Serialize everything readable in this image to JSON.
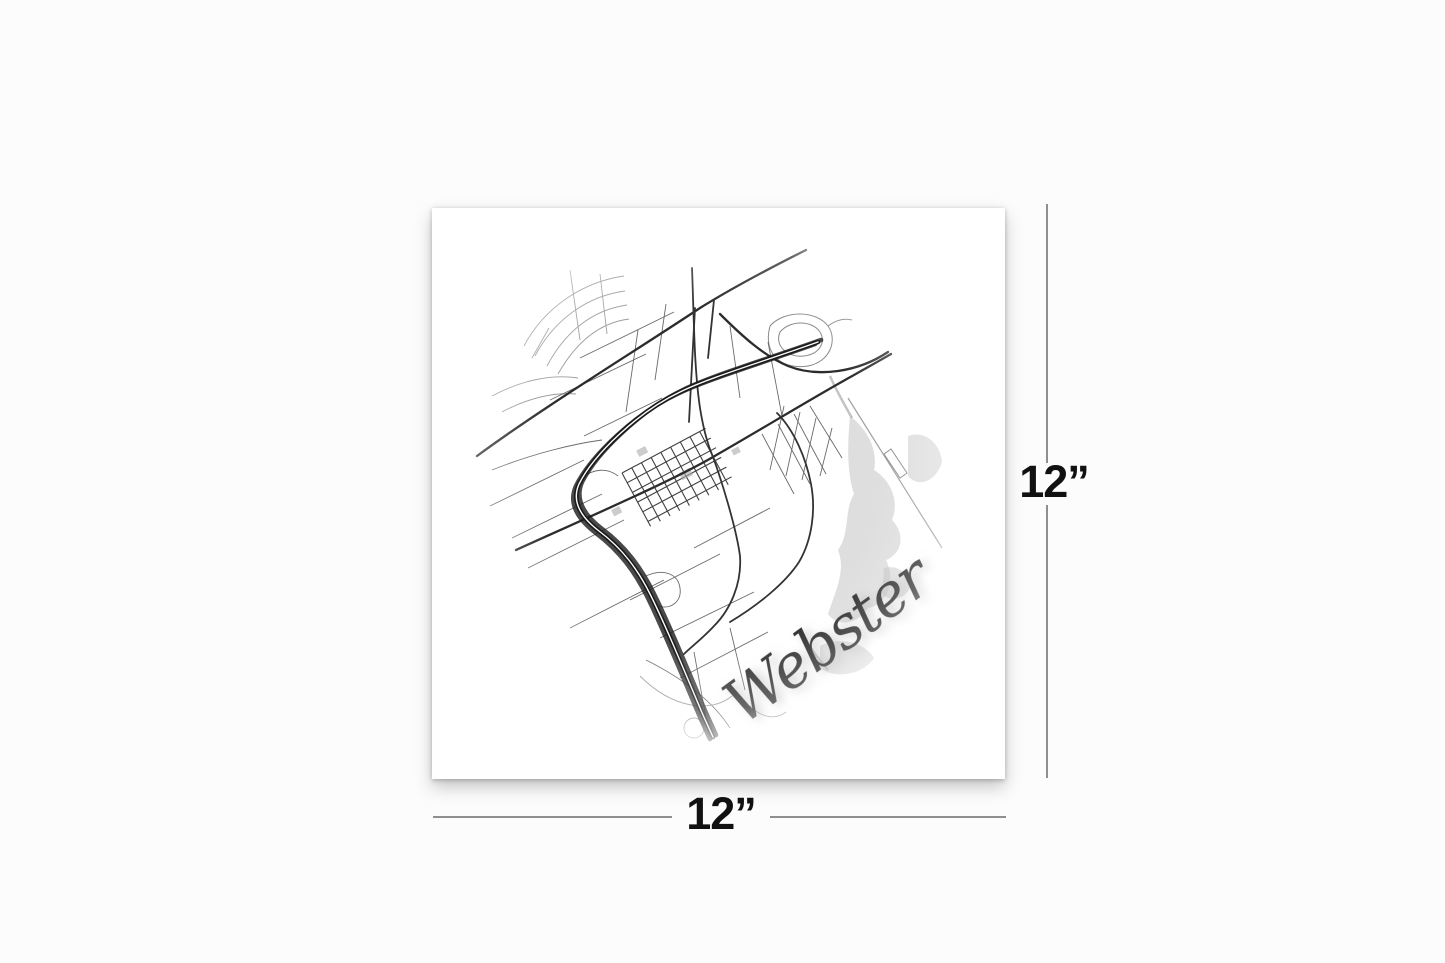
{
  "artwork": {
    "type": "minimalist-circular-city-street-map-print",
    "city_script": "Webster",
    "map_icon": "circular-street-map"
  },
  "dimensions": {
    "width_label": "12”",
    "height_label": "12”"
  },
  "colors": {
    "page_background": "#fcfcfc",
    "print_background": "#ffffff",
    "road_dark": "#1a1a1a",
    "road_medium": "#2c2c2c",
    "road_light": "#6a6a6a",
    "road_faint": "#999999",
    "water_gray": "#bdbdbd",
    "dimension_line": "#8f8f8f",
    "dimension_text": "#111111",
    "script_text": "#2d2d2d"
  }
}
